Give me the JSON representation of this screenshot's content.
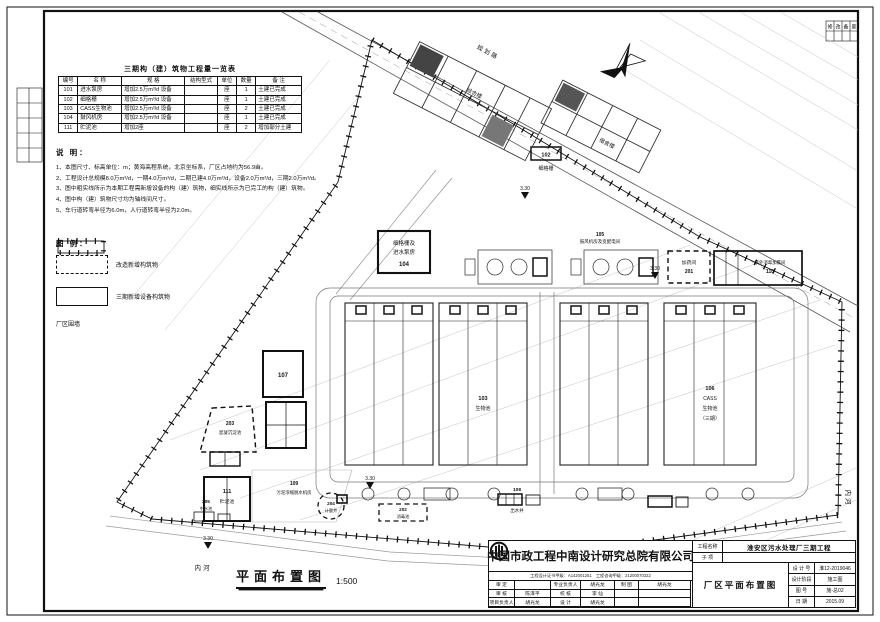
{
  "qty_table": {
    "title": "三期构（建）筑物工程量一览表",
    "headers": [
      "编号",
      "名  称",
      "规  格",
      "结构型式",
      "单位",
      "数量",
      "备  注"
    ],
    "rows": [
      [
        "101",
        "进水泵房",
        "增加2.5万m³/d 设备",
        "",
        "座",
        "1",
        "土建已完成"
      ],
      [
        "102",
        "细格栅",
        "增加2.5万m³/d 设备",
        "",
        "座",
        "1",
        "土建已完成"
      ],
      [
        "103",
        "CASS生物池",
        "增加2.5万m³/d 设备",
        "",
        "座",
        "2",
        "土建已完成"
      ],
      [
        "104",
        "鼓风机房",
        "增加2.5万m³/d 设备",
        "",
        "座",
        "1",
        "土建已完成"
      ],
      [
        "111",
        "贮泥池",
        "增加2座",
        "",
        "座",
        "2",
        "增加部分土建"
      ]
    ]
  },
  "notes": {
    "heading": "说 明：",
    "items": [
      "1、本图尺寸、标高单位：m；黄海高程系统，北京坐标系，厂区占地约为56.9亩。",
      "2、工程设计总规模8.0万m³/d，一期4.0万m³/d，二期已建4.0万m³/d，设备2.0万m³/d，三期2.0万m³/d。",
      "3、图中粗实线所示为本期工程需新增设备的构（建）筑物，细实线所示为已完工的构（建）筑物。",
      "4、图中构（建）筑物尺寸均为轴线间尺寸。",
      "5、车行道转弯半径为6.0m，人行道转弯半径为2.0m。"
    ]
  },
  "legend": {
    "heading": "图 例：",
    "items": [
      {
        "label": "改造新增构筑物"
      },
      {
        "label": "三期新增设备构筑物"
      },
      {
        "label": "厂区围墙"
      }
    ]
  },
  "plan": {
    "elevation": "3.30",
    "river_label": "内河",
    "road_label": "规划路",
    "scale": {
      "label": "平面布置图",
      "value": "1:500"
    },
    "structures": {
      "b1": {
        "name": "综合楼"
      },
      "b2": {
        "name": "宿舍楼"
      },
      "s102": {
        "num": "102",
        "name": "细格栅"
      },
      "s103": {
        "num": "103",
        "name": "生物池"
      },
      "s104": {
        "num": "104",
        "line1": "细格栅及",
        "line2": "进水泵房"
      },
      "s105": {
        "num": "105",
        "name": "鼓风机房及变配电间"
      },
      "s106": {
        "num": "106",
        "l1": "CASS",
        "l2": "生物池",
        "l3": "（三期）"
      },
      "s107": {
        "num": "107"
      },
      "s108": {
        "num": "108",
        "name": "出水井"
      },
      "s109": {
        "num": "109",
        "name": "污泥浓缩脱水机房"
      },
      "s110": {
        "num": "110",
        "name": "紫外消毒加氯间"
      },
      "s111": {
        "num": "111",
        "name": "贮泥池"
      },
      "s201": {
        "num": "201",
        "name": "加药间"
      },
      "s202": {
        "num": "202",
        "name": "消毒池"
      },
      "s203": {
        "num": "203",
        "name": "混凝沉淀池"
      },
      "s204": {
        "num": "204",
        "name": "计量井"
      },
      "s205": {
        "num": "205",
        "name": "中水池"
      }
    }
  },
  "revision": {
    "cells": [
      "修",
      "改",
      "备",
      "案"
    ]
  },
  "titleblock": {
    "company": "中国市政工程中南设计研究总院有限公司",
    "cert": "工程设计证书甲级：A142001251　工程咨询甲级：21200070322",
    "project_label": "工程名称",
    "project": "淮安区污水处理厂三期工程",
    "sub_label": "子  项",
    "sub": "",
    "drawing_title": "厂区平面布置图",
    "fields": [
      {
        "label": "设 计 号",
        "value": "淮12-2019046"
      },
      {
        "label": "设计阶段",
        "value": "施工图"
      },
      {
        "label": "图    号",
        "value": "施-总02"
      },
      {
        "label": "日    期",
        "value": "2015.09"
      }
    ],
    "sign_rows": [
      [
        "审  定",
        "",
        "专业负责人",
        "胡光龙",
        "制 图",
        "胡光龙"
      ],
      [
        "审  核",
        "陈泽平",
        "校  核",
        "李  仙",
        "",
        ""
      ],
      [
        "项目负责人",
        "胡光龙",
        "设  计",
        "胡光龙",
        "",
        ""
      ]
    ]
  }
}
